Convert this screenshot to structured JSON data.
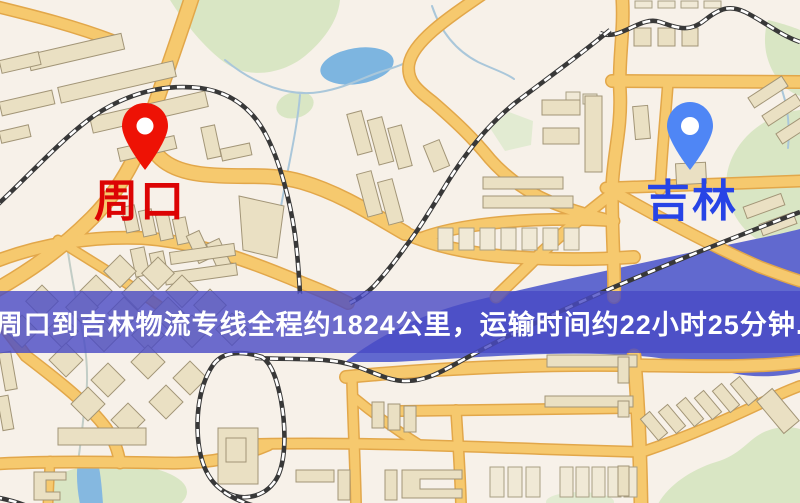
{
  "banner": {
    "text": "周口到吉林物流专线全程约1824公里，运输时间约22小时25分钟.",
    "bg_color": "#494ac4",
    "text_color": "#ffffff"
  },
  "origin": {
    "label": "周口",
    "label_color": "#dc0404",
    "pin_color": "#ee1205",
    "pin_icon": "map-pin"
  },
  "destination": {
    "label": "吉林",
    "label_color": "#2744e6",
    "pin_color": "#4f86f5",
    "pin_icon": "map-pin"
  },
  "map_palette": {
    "background": "#f7f1e9",
    "road": "#f6c96e",
    "road_casing": "#e2a74a",
    "building": "#eae0c3",
    "park": "#d9e6c4",
    "lake": "#7db5e0",
    "river": "#6169cf",
    "railway_dark": "#383838",
    "railway_light": "#ffffff"
  }
}
